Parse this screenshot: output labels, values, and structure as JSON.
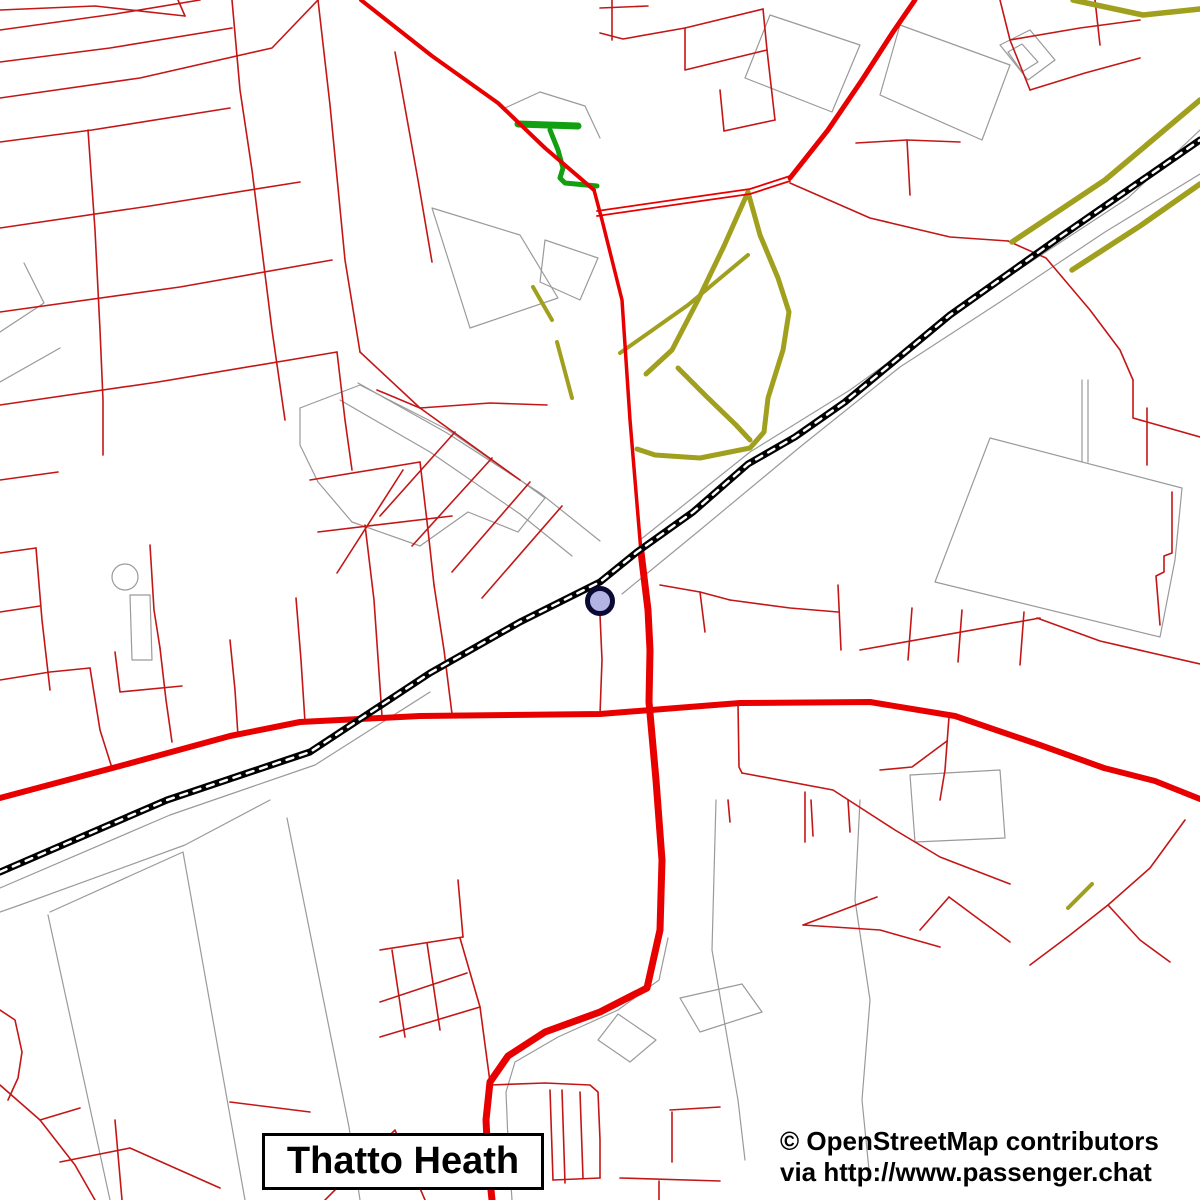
{
  "title_box": {
    "label": "Thatto Heath"
  },
  "attribution": {
    "line1": "© OpenStreetMap contributors",
    "line2": "via http://www.passenger.chat"
  },
  "station": {
    "cx": 600,
    "cy": 601,
    "r": 12.5,
    "fill": "#b4b4e4",
    "stroke": "#0a0a35",
    "stroke_width": 5
  },
  "colors": {
    "background": "#ffffff",
    "minor_road": "#c41616",
    "major_road": "#e80000",
    "path_olive": "#a0a01e",
    "path_green": "#12a012",
    "outline_gray": "#9a9a9a",
    "railway": "#000000",
    "railway_dash": "#ffffff",
    "label_text": "#000000"
  },
  "layers": {
    "gray_circles": [
      {
        "cx": 125,
        "cy": 577,
        "r": 13
      }
    ],
    "gray_lines": [
      "358,383 447,433 540,493 600,541",
      "340,400 430,452 520,514 572,556",
      "300,408 360,385 448,430 520,480 545,498 518,532 468,512 420,546 352,522 318,482 300,445 300,408",
      "432,208 520,235 558,298 470,328 432,208",
      "545,240 598,258 580,300 540,282 545,240",
      "990,438 1182,488 1175,560 1160,637 935,582 990,438",
      "1082,380 1082,462",
      "1088,380 1088,462",
      "910,775 1000,770 1005,838 915,842 910,775",
      "270,800 185,845 20,905 0,912",
      "50,912 183,852 245,1200",
      "48,915 110,1200",
      "287,818 349,1127 360,1200",
      "668,938 659,980 618,1010 558,1037 515,1062 506,1092 508,1140 512,1200",
      "680,998 742,984 762,1012 700,1032 680,998",
      "618,1014 656,1040 630,1062 598,1040 618,1014",
      "716,800 712,950 738,1100 745,1160",
      "860,800 855,900 870,1000 862,1100 870,1180",
      "640,540 750,452 850,390 1000,282 1128,198 1200,130",
      "622,594 700,530 800,447 900,367 1000,302 1105,232 1200,174",
      "0,888 170,815 315,765 430,692",
      "1000,45 1030,30 1055,60 1028,80 1000,45",
      "1008,52 1022,44 1038,62 1022,72 1008,52",
      "770,15 860,45 832,112 745,78 770,15",
      "900,25 1010,65 982,140 880,95 900,25",
      "505,108 540,92 585,106 600,138",
      "0,332 44,303 24,263",
      "0,382 60,348",
      "130,595 150,595 152,660 132,660 130,595"
    ],
    "minor_red": [
      "0,10 95,6 185,16",
      "185,16 178,0",
      "0,30 115,14 200,0",
      "0,98 140,78 272,48 318,0",
      "0,62 110,48 232,28",
      "232,0 240,90 252,170 262,250 272,330 285,420",
      "0,142 92,130 230,108",
      "0,228 150,206 300,182",
      "0,312 180,287 332,260",
      "0,405 158,382 337,352",
      "88,130 95,230 100,330 103,400 103,455",
      "318,0 330,105 345,260 360,352",
      "395,52 418,180 432,262",
      "360,352 420,408",
      "337,352 345,420 352,470",
      "0,480 58,472",
      "0,553 36,548",
      "150,545 154,610 160,648",
      "115,652 120,692 182,686",
      "36,548 42,620 50,690",
      "310,480 420,462",
      "318,532 452,516",
      "420,462 428,530 434,585",
      "455,432 380,516",
      "492,458 412,546",
      "530,482 452,572",
      "562,506 482,598",
      "403,470 337,573",
      "420,408 520,480",
      "420,408 490,403 547,405",
      "377,390 420,408",
      "600,615 602,660 600,714",
      "434,585 444,650 452,714",
      "365,525 374,600 382,716",
      "296,598 301,660 305,722",
      "230,640 235,690 238,736",
      "90,668 100,730 112,768",
      "0,680 50,672 90,668",
      "0,612 40,606",
      "160,648 166,700 172,742",
      "600,8 648,6",
      "612,0 612,40",
      "600,33 623,39 685,28 763,9",
      "763,9 767,50 775,120",
      "685,28 685,70 767,50",
      "775,120 724,131",
      "724,131 720,90",
      "856,143 907,140 960,142",
      "907,140 910,195",
      "1000,0 1010,40 1030,90",
      "1030,90 1085,73 1140,58",
      "1095,0 1100,45",
      "1010,40 1080,28 1140,20",
      "790,183 870,218 950,237 1008,241",
      "1008,241 1046,258 1090,310 1120,350 1133,380",
      "1133,380 1133,418 1200,437",
      "1147,408 1147,465",
      "1172,492 1172,553 1164,556 1164,572 1156,576 1160,625",
      "1037,618 1100,641 1200,664",
      "860,650 1040,618",
      "908,660 912,608",
      "958,662 962,610",
      "1020,665 1024,612",
      "660,585 700,592 730,600",
      "700,592 705,632",
      "730,600 790,608 838,612",
      "838,585 841,650",
      "949,717 945,770 940,800",
      "738,703 739,767 742,773",
      "742,773 833,790 895,830 940,857 1010,884",
      "805,792 805,842",
      "880,770 912,767 947,741",
      "1185,820 1150,868 1108,905 1070,935 1030,965",
      "1108,905 1140,940 1170,962",
      "949,897 980,920 1010,942",
      "920,930 949,897",
      "803,925 877,897",
      "803,925 880,930 940,947",
      "728,800 730,822",
      "811,800 813,836",
      "848,800 850,832",
      "490,1085 545,1083 590,1085 598,1092 600,1140 600,1178",
      "550,1090 553,1180",
      "562,1090 565,1183",
      "580,1092 583,1178",
      "553,1180 600,1178",
      "670,1110 720,1107",
      "672,1112 672,1162",
      "620,1178 720,1181",
      "659,1181 659,1200",
      "380,950 463,937",
      "380,1002 467,973",
      "380,1037 480,1007",
      "392,950 405,1037",
      "460,938 480,1007",
      "427,943 440,1030",
      "463,937 458,880",
      "480,1007 490,1082",
      "325,1200 395,1130 425,1200",
      "0,1010 15,1020 22,1052 18,1078 8,1100",
      "0,1085 40,1120 75,1165 95,1200",
      "40,1120 80,1108",
      "115,1120 122,1200",
      "60,1162 130,1148 220,1188",
      "230,1102 310,1112"
    ],
    "olive": [
      {
        "w": 5,
        "pts": "748,192 760,235 778,278 789,312 783,350 768,398 764,432 750,448 700,458 655,455 637,449"
      },
      {
        "w": 5,
        "pts": "748,192 724,246 698,300 672,350 646,374"
      },
      {
        "w": 5,
        "pts": "678,368 706,396 736,425 750,440"
      },
      {
        "w": 4,
        "pts": "620,353 688,305 748,255"
      },
      {
        "w": 4,
        "pts": "533,287 552,320"
      },
      {
        "w": 4,
        "pts": "557,342 572,398"
      },
      {
        "w": 5.5,
        "pts": "1012,242 1105,180 1200,100"
      },
      {
        "w": 5.5,
        "pts": "1072,270 1140,226 1200,184"
      },
      {
        "w": 5.5,
        "pts": "1073,0 1143,15 1200,9"
      },
      {
        "w": 4,
        "pts": "1068,908 1092,884"
      }
    ],
    "green": [
      {
        "w": 7,
        "pts": "518,124 578,126"
      },
      {
        "w": 5,
        "pts": "550,130 558,150 563,168 560,178 565,183 597,186"
      }
    ],
    "major_red": [
      {
        "w": 4,
        "pts": "361,0 432,56 498,103 545,148 594,190"
      },
      {
        "w": 3.5,
        "pts": "594,190 602,220 622,300 630,420 641,552"
      },
      {
        "w": 7,
        "pts": "641,552 648,610 650,650 649,702 656,780 662,860 660,930 647,988 600,1012 545,1032 508,1056 490,1082 486,1120 488,1160 492,1200"
      },
      {
        "w": 6,
        "pts": "0,798 120,766 230,736 300,722 420,716 600,714 740,703 870,702 955,716 1040,745 1104,768 1155,781 1200,799"
      },
      {
        "w": 1.8,
        "pts": "597,216 680,204 750,194 790,181"
      },
      {
        "w": 1.8,
        "pts": "597,211 680,199 750,189 790,176"
      },
      {
        "w": 5,
        "pts": "790,178 828,130 862,80 893,32 915,0"
      }
    ],
    "railway": {
      "w": 7,
      "dash_w": 2.5,
      "dash": "7 7",
      "pts": "0,872 167,800 310,752 430,673 520,622 600,582 637,552 693,512 748,464 795,437 845,402 950,315 1060,237 1200,140"
    }
  }
}
